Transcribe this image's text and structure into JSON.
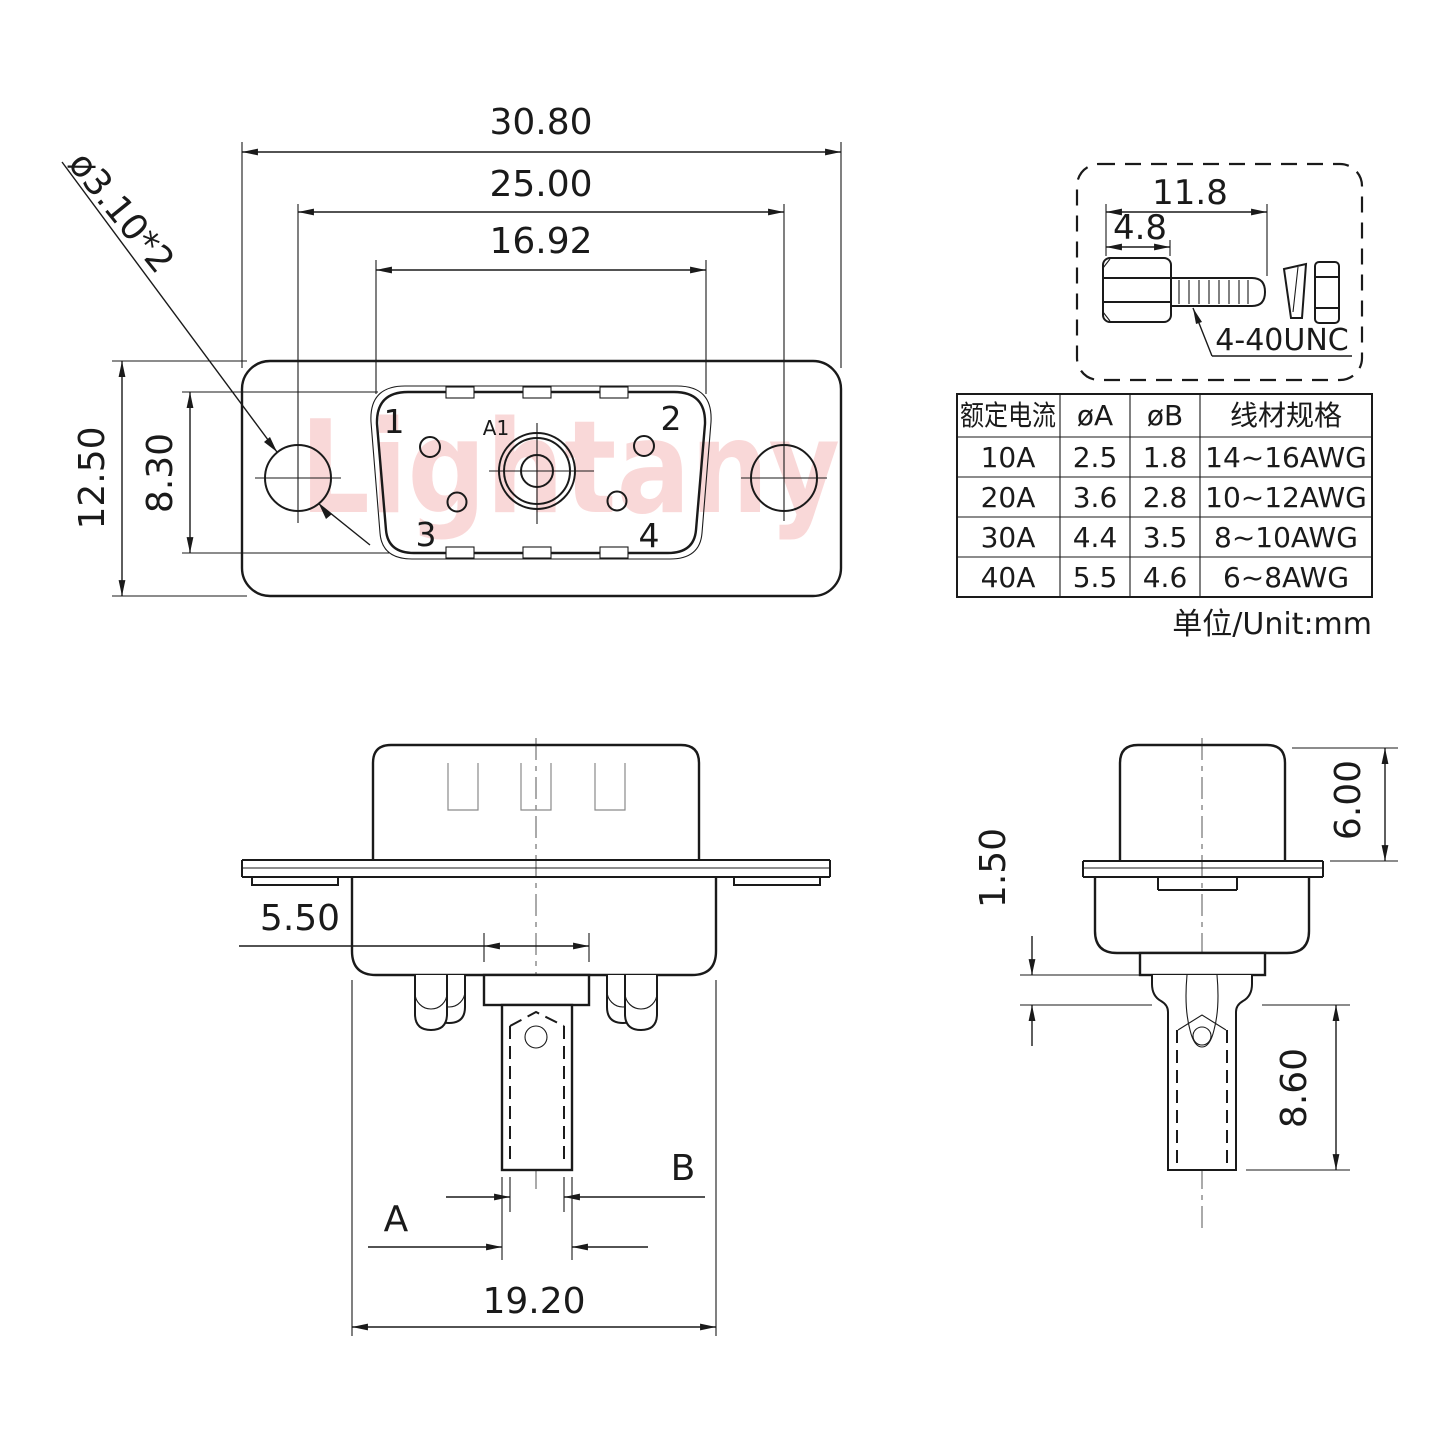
{
  "watermark": "Lightany",
  "colors": {
    "line": "#1a1a1a",
    "watermark": "#f8caca"
  },
  "front_view": {
    "dim_overall_width": "30.80",
    "dim_hole_spacing": "25.00",
    "dim_insert_width": "16.92",
    "dim_overall_height": "12.50",
    "dim_insert_height": "8.30",
    "dim_mount_hole": "ø3.10*2",
    "pins": {
      "p1": "1",
      "p2": "2",
      "p3": "3",
      "p4": "4",
      "center": "A1"
    }
  },
  "screw_detail": {
    "dim_total_length": "11.8",
    "dim_head_length": "4.8",
    "thread_spec": "4-40UNC"
  },
  "spec_table": {
    "headers": [
      "额定电流",
      "øA",
      "øB",
      "线材规格"
    ],
    "rows": [
      [
        "10A",
        "2.5",
        "1.8",
        "14~16AWG"
      ],
      [
        "20A",
        "3.6",
        "2.8",
        "10~12AWG"
      ],
      [
        "30A",
        "4.4",
        "3.5",
        "8~10AWG"
      ],
      [
        "40A",
        "5.5",
        "4.6",
        "6~8AWG"
      ]
    ],
    "unit_note": "单位/Unit:mm"
  },
  "bottom_section_view": {
    "dim_slot_width": "5.50",
    "dim_body_width": "19.20",
    "label_dim_a": "A",
    "label_dim_b": "B"
  },
  "bottom_side_view": {
    "dim_hood_height": "6.00",
    "dim_flange_offset": "1.50",
    "dim_barrel_length": "8.60"
  }
}
